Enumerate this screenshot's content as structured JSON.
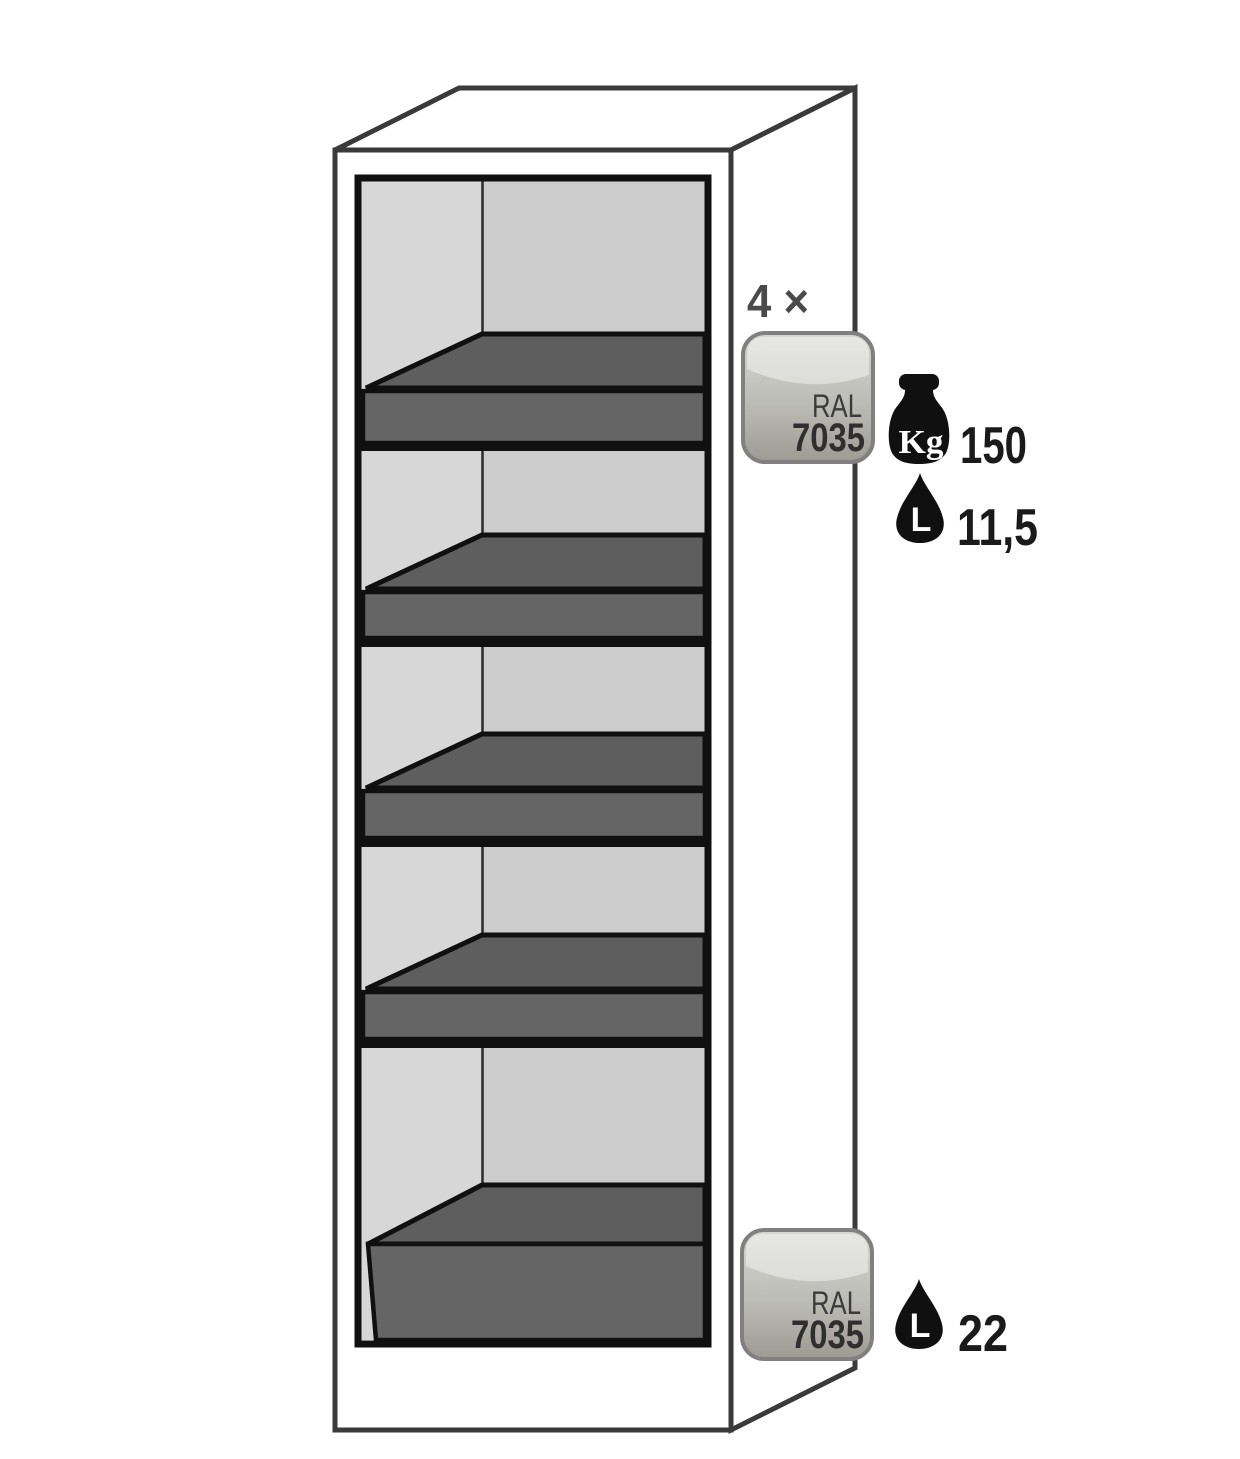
{
  "figure": {
    "kind": "safety-cabinet-interior-diagram",
    "description": "Tall safety cabinet shown in cutaway perspective with four pull-out shelf trays and one bottom sump tray"
  },
  "annotations": {
    "top": {
      "count": "4 ×",
      "badge": {
        "line1": "RAL",
        "line2": "7035"
      },
      "load": {
        "unit": "Kg",
        "value": "150"
      },
      "volume": {
        "unit": "L",
        "value": "11,5"
      }
    },
    "bottom": {
      "badge": {
        "line1": "RAL",
        "line2": "7035"
      },
      "volume": {
        "unit": "L",
        "value": "22"
      }
    }
  },
  "cabinet": {
    "shelf_tray_count": 4,
    "sump_tray_count": 1
  },
  "colors": {
    "outline": "#3a3a3a",
    "ink": "#101010",
    "back_wall": "#cccccc",
    "left_wall": "#d7d7d7",
    "tray_floor": "#5e5e5e",
    "tray_front": "#656565",
    "badge_border": "#808080",
    "badge_top": "#d6d6d2",
    "badge_bottom": "#9e9a94",
    "count_text": "#4a4a4a",
    "ral_text": "#3b3b3b",
    "ral_code_text": "#2f2f2f",
    "value_text": "#1a1a1a"
  }
}
